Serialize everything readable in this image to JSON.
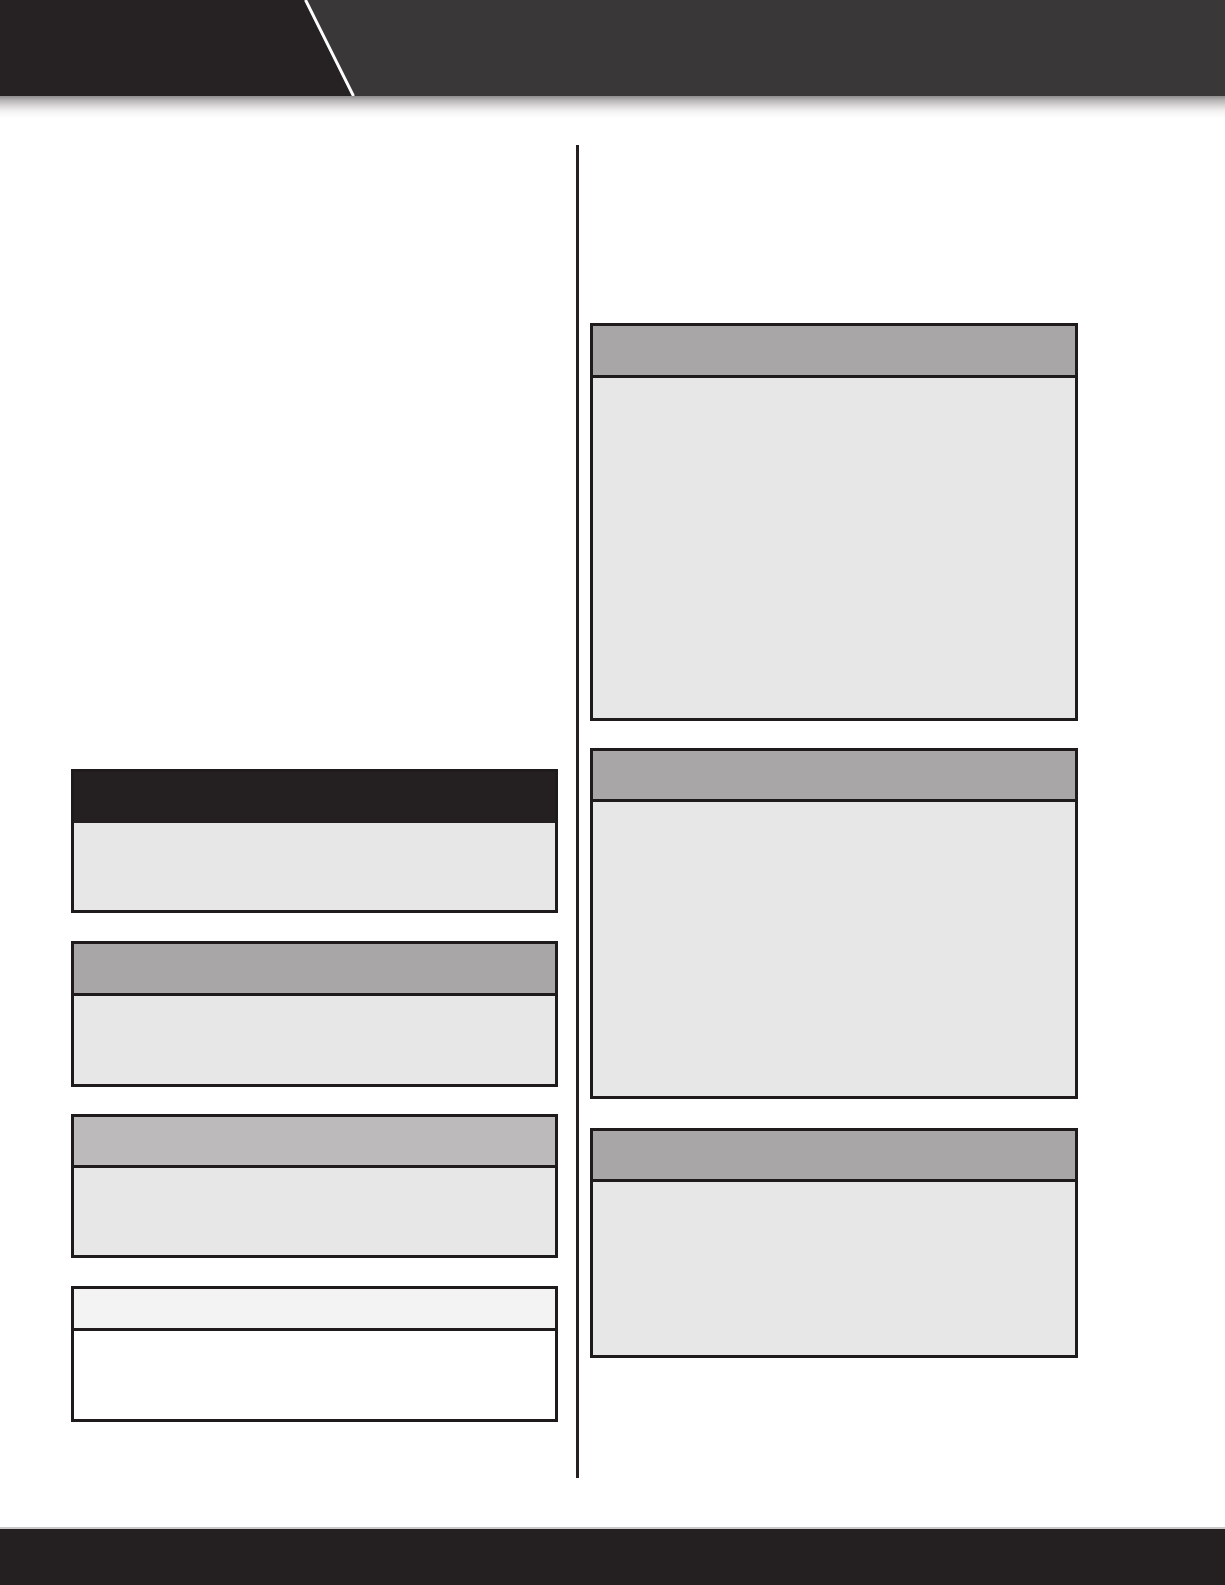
{
  "page": {
    "background_color": "#ffffff"
  },
  "banner": {
    "left_band_color": "#262223",
    "right_band_color": "#3a3738",
    "diagonal_line_color": "#ffffff",
    "trim_strip_color": "#b5b2b3"
  },
  "column_divider": {
    "color": "#241f20"
  },
  "columns": {
    "left": {
      "panels": [
        {
          "id": "left-panel-1",
          "header_style": "black",
          "header_color": "#241f20",
          "body_color": "#e7e7e7",
          "header_text": "",
          "body_text": ""
        },
        {
          "id": "left-panel-2",
          "header_style": "gray",
          "header_color": "#a8a6a7",
          "body_color": "#e7e7e7",
          "header_text": "",
          "body_text": ""
        },
        {
          "id": "left-panel-3",
          "header_style": "light-gray",
          "header_color": "#bcbabb",
          "body_color": "#e7e7e7",
          "header_text": "",
          "body_text": ""
        },
        {
          "id": "left-panel-4",
          "header_style": "white",
          "header_color": "#f4f3f3",
          "body_color": "#ffffff",
          "header_text": "",
          "body_text": ""
        }
      ]
    },
    "right": {
      "panels": [
        {
          "id": "right-panel-1",
          "header_style": "gray",
          "header_color": "#a8a6a7",
          "body_color": "#e7e7e7",
          "header_text": "",
          "body_text": ""
        },
        {
          "id": "right-panel-2",
          "header_style": "gray",
          "header_color": "#a8a6a7",
          "body_color": "#e7e7e7",
          "header_text": "",
          "body_text": ""
        },
        {
          "id": "right-panel-3",
          "header_style": "gray",
          "header_color": "#a8a6a7",
          "body_color": "#e7e7e7",
          "header_text": "",
          "body_text": ""
        }
      ]
    }
  },
  "footer": {
    "bar_color": "#241f20",
    "hairline_color": "#cac8c8"
  }
}
